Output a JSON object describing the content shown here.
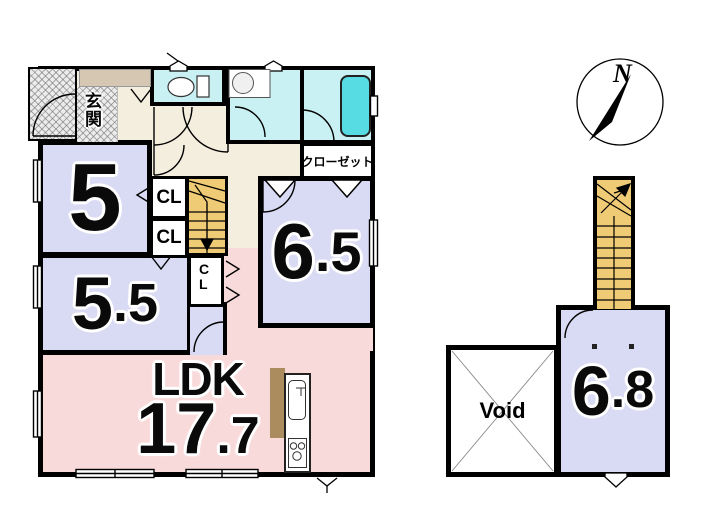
{
  "compass": {
    "north_label": "N"
  },
  "first_floor": {
    "entrance_label": "玄関",
    "closet_label": "クローゼット",
    "cl_upper_label": "CL",
    "cl_lower_label": "CL",
    "cl_side_label": "CL",
    "room_5": {
      "size": "5"
    },
    "room_5_5": {
      "size_int": "5",
      "size_dec": ".5"
    },
    "room_6_5": {
      "size_int": "6",
      "size_dec": ".5"
    },
    "ldk": {
      "name": "LDK",
      "size_int": "17",
      "size_dec": ".7"
    }
  },
  "second_floor": {
    "room_6_8": {
      "size_int": "6",
      "size_dec": ".8"
    },
    "void_label": "Void"
  },
  "colors": {
    "wall": "#000000",
    "room_lavender": "#d9daf3",
    "ldk_pink": "#f9dada",
    "wet_room_cyan": "#c9f0f2",
    "bathtub_cyan": "#58dce3",
    "stairs_orange": "#f0cb76",
    "hallway_cream": "#f3eedd",
    "cabinet_taupe": "#d5c7b2",
    "kitchen_brown": "#ab8c5e"
  }
}
